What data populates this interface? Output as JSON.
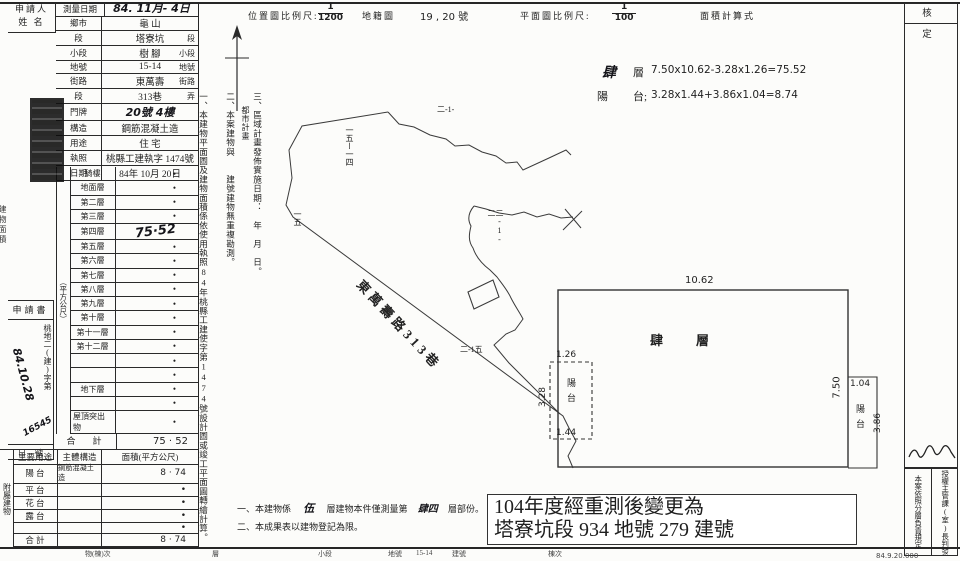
{
  "applicant": {
    "line1": "申請人",
    "line2": "姓 名"
  },
  "left_table": {
    "survey": {
      "label": "測量日期",
      "value": "84. 11月- 4日"
    },
    "loc_rows": [
      {
        "label": "鄉市",
        "value": "龜 山",
        "suffix": "",
        "hw": false
      },
      {
        "label": "段",
        "value": "塔寮坑",
        "suffix": "段",
        "hw": false
      },
      {
        "label": "小段",
        "value": "樹 腳",
        "suffix": "小段",
        "hw": false
      },
      {
        "label": "地號",
        "value": "15-14",
        "suffix": "地號",
        "hw": false
      },
      {
        "label": "街路",
        "value": "東萬壽",
        "suffix": "街路",
        "hw": false
      },
      {
        "label": "段",
        "value": "313巷",
        "suffix": "弄",
        "hw": false
      },
      {
        "label": "門牌",
        "value": "20號 4樓",
        "suffix": "",
        "hw": true
      },
      {
        "label": "構造",
        "value": "鋼筋混凝土造",
        "suffix": "",
        "hw": false
      },
      {
        "label": "用途",
        "value": "住 宅",
        "suffix": "",
        "hw": false
      },
      {
        "label": "執照",
        "value": "桃縣工建執字 1474號",
        "suffix": "",
        "hw": false
      },
      {
        "label": "日期",
        "value": "84年 10月 20日",
        "suffix": "",
        "hw": false
      }
    ],
    "floor_rows": [
      {
        "label": "騎樓",
        "value": "•",
        "hw": false
      },
      {
        "label": "地面層",
        "value": "•",
        "hw": false
      },
      {
        "label": "第二層",
        "value": "•",
        "hw": false
      },
      {
        "label": "第三層",
        "value": "•",
        "hw": false
      },
      {
        "label": "第四層",
        "value": "75·52",
        "hw": true
      },
      {
        "label": "第五層",
        "value": "•",
        "hw": false
      },
      {
        "label": "第六層",
        "value": "•",
        "hw": false
      },
      {
        "label": "第七層",
        "value": "•",
        "hw": false
      },
      {
        "label": "第八層",
        "value": "•",
        "hw": false
      },
      {
        "label": "第九層",
        "value": "•",
        "hw": false
      },
      {
        "label": "第十層",
        "value": "•",
        "hw": false
      },
      {
        "label": "第十一層",
        "value": "•",
        "hw": false
      },
      {
        "label": "第十二層",
        "value": "•",
        "hw": false
      },
      {
        "label": "",
        "value": "•",
        "hw": false
      },
      {
        "label": "",
        "value": "•",
        "hw": false
      },
      {
        "label": "地下層",
        "value": "•",
        "hw": false
      },
      {
        "label": "",
        "value": "•",
        "hw": false
      },
      {
        "label": "屋頂突出物",
        "value": "•",
        "hw": false
      }
    ],
    "total": {
      "label": "合　計",
      "value": "75 · 52"
    },
    "group_labels": {
      "area_unit": "（平方公尺）",
      "area_name": "建物面積",
      "annex": "附屬建物"
    },
    "annex": {
      "headers": [
        "主要用途",
        "主體構造",
        "面積(平方公尺)"
      ],
      "rows": [
        {
          "use": "陽 台",
          "structure": "鋼筋混凝土造",
          "area": "8 · 74"
        },
        {
          "use": "平 台",
          "structure": "",
          "area": "•"
        },
        {
          "use": "花 台",
          "structure": "",
          "area": "•"
        },
        {
          "use": "露 台",
          "structure": "",
          "area": "•"
        },
        {
          "use": "",
          "structure": "",
          "area": "•"
        },
        {
          "use": "合 計",
          "structure": "",
          "area": "8 · 74"
        }
      ]
    }
  },
  "margin": {
    "app_header": "申請書",
    "app_prefix": "桃地二(建)字第",
    "app_date_hw": "84.10.28",
    "app_no_hw": "16545",
    "app_footer": "日　號"
  },
  "header": {
    "loc_scale_label": "位置圖比例尺:",
    "loc_num": "1",
    "loc_den": "1200",
    "cadastral_label": "地籍圖",
    "sheet_no": "19 , 20 號",
    "plan_scale_label": "平面圖比例尺:",
    "plan_num": "1",
    "plan_den": "100",
    "area_calc_label": "面積計算式"
  },
  "notes": {
    "n1": "一、本建物平面圖及建物面積係依使用執照84年桃縣工建使字第1474號設計圖或竣工平面圖轉繪計算。",
    "n2": "二、本案建物與　　建號建物無重複勘測。",
    "n3": "三、區域計畫發佈實施日期：　年　月　日。",
    "n3b": "都市計畫"
  },
  "site": {
    "road_label": "東萬壽路313巷",
    "parcel_1": "二-1-",
    "parcel_2": "一五ー一四",
    "parcel_3": "一五",
    "parcel_4": "二-1-二",
    "parcel_5": "二-1五"
  },
  "formulas": {
    "floor_name": "肆",
    "floor_word": "層",
    "floor_expr": "7.50x10.62-3.28x1.26=75.52",
    "balcony_name": "陽",
    "balcony_word": "台;",
    "balcony_expr": "3.28x1.44+3.86x1.04=8.74"
  },
  "plan": {
    "room_label": "肆　層",
    "dim_top": "10.62",
    "dim_right": "7.50",
    "balcony_left": {
      "top": "1.26",
      "side": "3.28",
      "bottom": "1.44",
      "label": "陽台"
    },
    "balcony_right": {
      "top": "1.04",
      "side": "3.86",
      "label": "陽台"
    }
  },
  "approval": {
    "header": "核　定",
    "note_right": "授權主管課(室)長判發",
    "note_left": "本案依照分層負責規定",
    "print_code": "84.9.20.000"
  },
  "bottom": {
    "n1a": "一、本建物係",
    "n1b": "伍",
    "n1c": "層建物本件僅測量第",
    "n1d": "肆四",
    "n1e": "層部份。",
    "n2": "二、本成果表以建物登記為限。",
    "remark1": "104年度經重測後變更為",
    "remark2": "塔寮坑段 934 地號 279 建號"
  },
  "footer_fragments": [
    {
      "x": 85,
      "t": "物(棟)次"
    },
    {
      "x": 212,
      "t": "層"
    },
    {
      "x": 318,
      "t": "小段"
    },
    {
      "x": 388,
      "t": "地號"
    },
    {
      "x": 416,
      "t": "15-14"
    },
    {
      "x": 452,
      "t": "建號"
    },
    {
      "x": 548,
      "t": "棟次"
    }
  ]
}
